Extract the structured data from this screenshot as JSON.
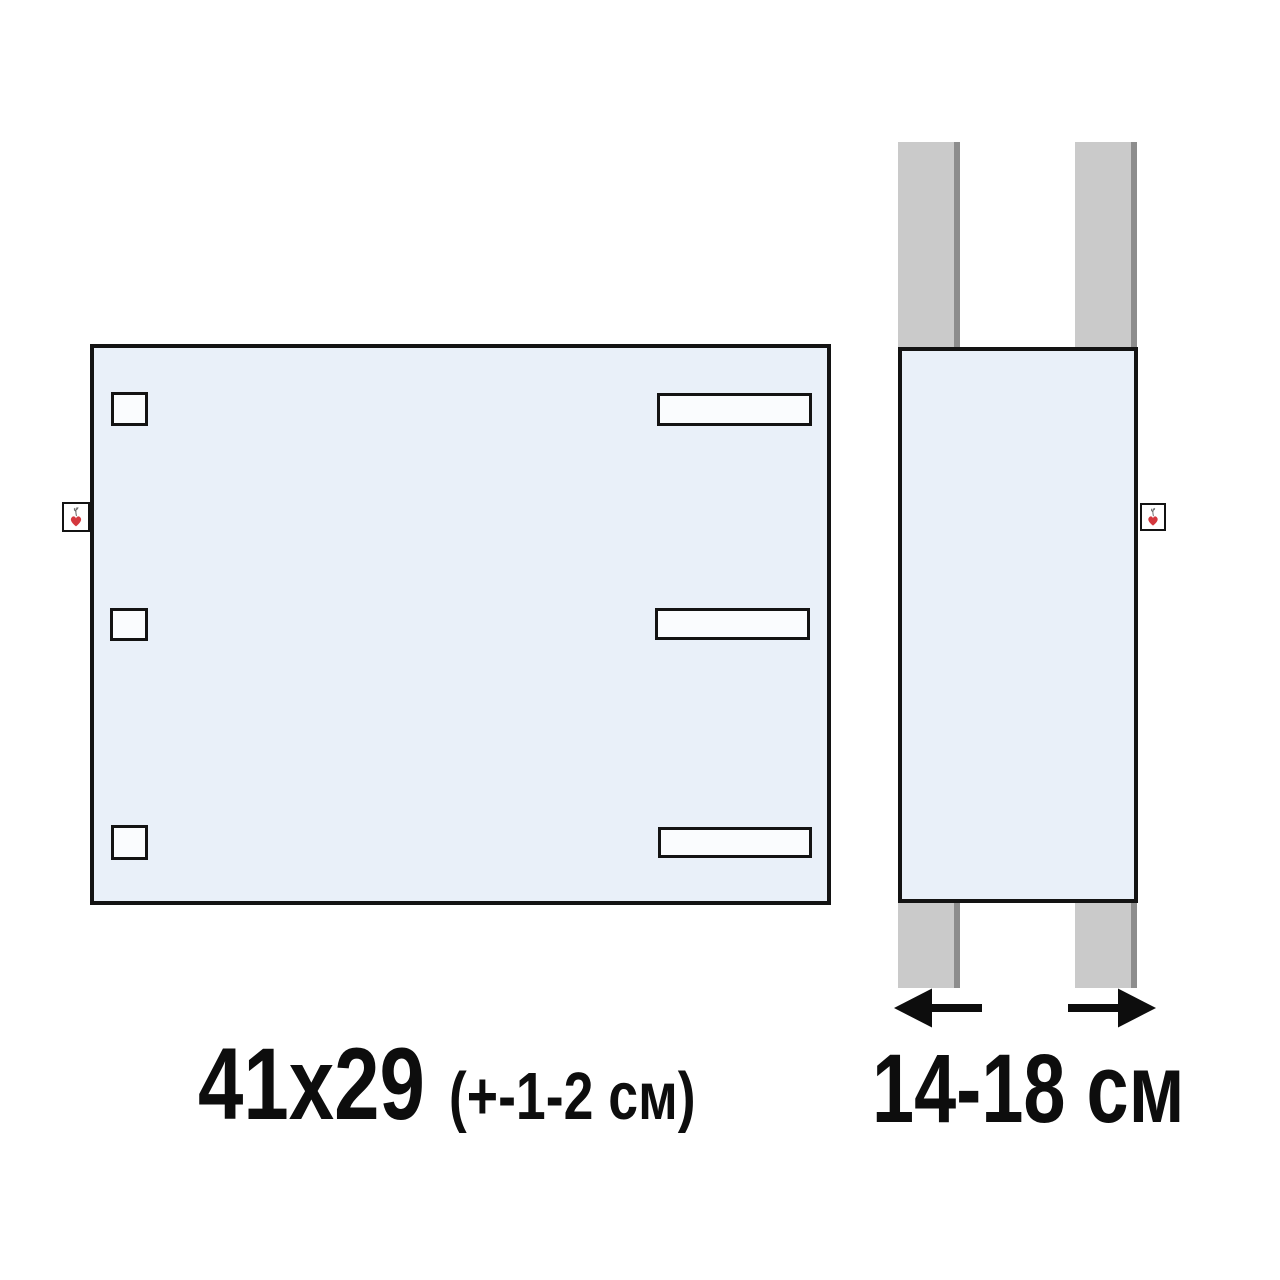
{
  "labels": {
    "front_size": "41x29",
    "front_tolerance": "(+-1-2 см)",
    "strap_width": "14-18 см"
  },
  "icons": {
    "brand_tag": "heart-sprout-icon",
    "measure_left": "arrow-left-icon",
    "measure_right": "arrow-right-icon"
  },
  "colors": {
    "fabric_blue": "#e9f0f9",
    "outline": "#131313",
    "cutout": "#fafcfe",
    "strap_gray": "#cacaca",
    "strap_shadow": "#8d8d8d",
    "heart_red": "#d4383e",
    "text": "#0d0d0d",
    "bg": "#ffffff"
  }
}
